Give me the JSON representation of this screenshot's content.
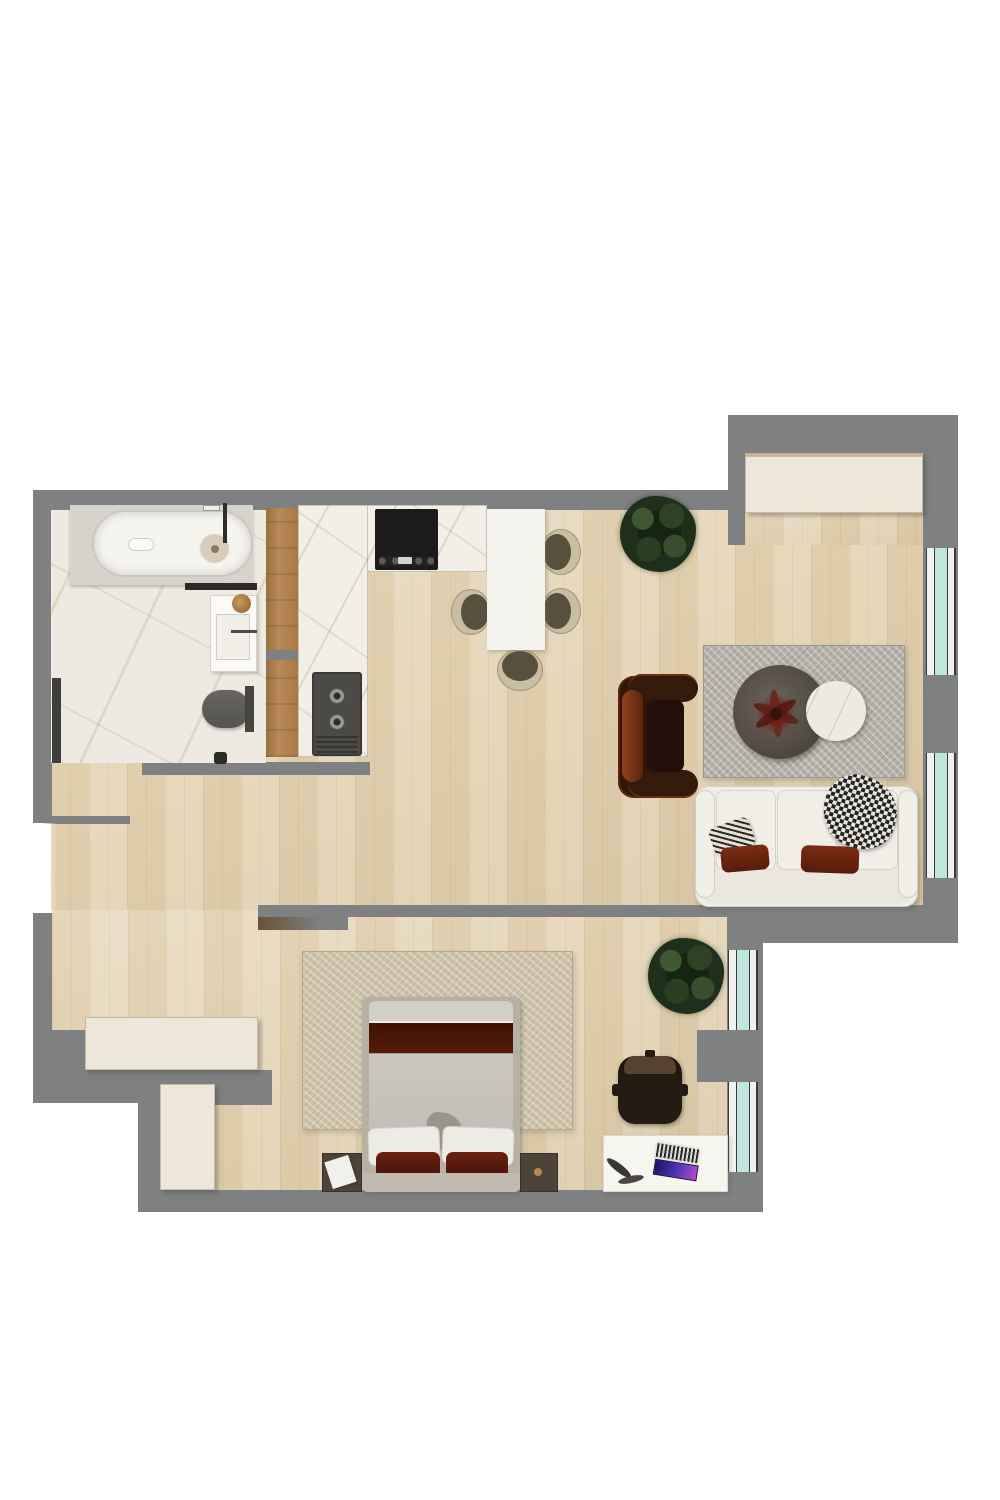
{
  "page": {
    "kind": "3d-rendered-floor-plan-top-view",
    "background": "#ffffff"
  },
  "palette": {
    "outside": "#ffffff",
    "wall": "#7e8082",
    "wall_dark": "#6e7072",
    "floor_wood_light": "#e7d8bc",
    "floor_wood_dark": "#dfcdab",
    "bathroom_marble": "#efeae1",
    "counter_marble": "#f3efe7",
    "window_glass": "#bfe6dd",
    "window_frame": "#f0f0ee",
    "wood_partition": "#b98a57",
    "cream_unit": "#ece7da",
    "tub_white": "#f6f4ee",
    "fixture_dark": "#5f5e5a",
    "cooktop_black": "#1c1b19",
    "kitchen_sink_dark": "#4b4a46",
    "dining_table_white": "#f5f3ee",
    "chair_beige": "#c9bda2",
    "chair_seat_dark": "#57503c",
    "living_rug_gray": "#b5b1a8",
    "coffee_table_dark": "#554e45",
    "side_table_marble": "#eceae3",
    "flower_red": "#6e241a",
    "armchair_dark": "#2f1608",
    "armchair_rust": "#8a3a14",
    "sofa_white": "#f0ede6",
    "pillow_rust": "#6e2510",
    "bedroom_rug_beige": "#cdc2a7",
    "bed_frame_greige": "#b7b1a4",
    "bed_blanket_maroon": "#461507",
    "bed_duvet_gray": "#cac7c0",
    "pillow_white": "#edebe5",
    "nightstand_brown": "#4e4339",
    "desk_white": "#f7f5f0",
    "desk_chair_black": "#17120c",
    "desk_chair_brown": "#56422e",
    "laptop_screen_purple": "#5436b8",
    "plant_green": "#2c4423",
    "gold_accent": "#a97b44"
  },
  "rooms": {
    "bathroom": {
      "items": [
        "bathtub",
        "tub-platform",
        "vanity-sink",
        "vessel-bowl",
        "toilet",
        "shower-glass-strip",
        "marble-floor"
      ]
    },
    "kitchen": {
      "items": [
        "l-shaped-marble-counter",
        "cooktop",
        "double-sink-unit",
        "wood-slat-partition"
      ]
    },
    "dining": {
      "items": [
        "white-dining-table",
        "dining-chair-1",
        "dining-chair-2",
        "dining-chair-3",
        "dining-chair-4"
      ]
    },
    "living_room": {
      "items": [
        "gray-area-rug",
        "round-coffee-table-dark",
        "round-side-table-marble",
        "flower-centerpiece",
        "rust-armchair",
        "white-three-seat-sofa",
        "houndstooth-throw",
        "patterned-pillow",
        "rust-pillow-left",
        "rust-pillow-right"
      ]
    },
    "bedroom": {
      "items": [
        "beige-area-rug",
        "double-bed",
        "nightstand-left",
        "nightstand-right",
        "white-desk",
        "desk-chair",
        "laptop",
        "decor-feather"
      ]
    },
    "hallway": {
      "items": [
        "entry-door-opening",
        "wardrobe-long",
        "wardrobe-short"
      ]
    },
    "balcony_nook": {
      "items": [
        "built-in-cabinet"
      ]
    },
    "plants": [
      "potted-plant-top",
      "potted-plant-middle"
    ],
    "windows": [
      "right-window-upper",
      "right-window-lower",
      "bedroom-window-upper",
      "bedroom-window-lower"
    ]
  }
}
